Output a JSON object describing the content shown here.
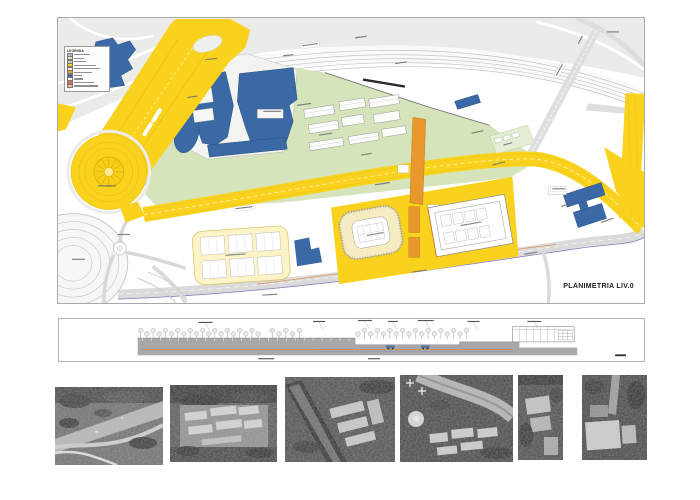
{
  "page": {
    "background": "#ffffff"
  },
  "plan_panel": {
    "title": "PLANIMETRIA LIV.0",
    "legend": {
      "header": "LEGENDA",
      "swatches": [
        {
          "color": "#a9bdd1"
        },
        {
          "color": "#dce9c6"
        },
        {
          "color": "#c3d89b"
        },
        {
          "color": "#f8d21c"
        },
        {
          "color": "#fbf3c8"
        },
        {
          "color": "#eca22e"
        },
        {
          "color": "#3b69a5"
        },
        {
          "color": "#ffffff"
        },
        {
          "color": "#d96a55"
        },
        {
          "color": "#f0bd8d"
        }
      ]
    },
    "palette": {
      "road_yellow": "#f8d21c",
      "overpass_orange": "#eca22e",
      "building_blue": "#3b69a5",
      "lawn_green": "#d5e4ba",
      "sports_green": "#e4eed6",
      "road_gray": "#dedede",
      "tram_purple": "#8d80bd",
      "utility_orange_line": "#df8a3a",
      "paving_pale_yellow": "#fcf4c6"
    }
  },
  "section_panel": {
    "palette": {
      "ground_gray": "#a8a8a8",
      "line_orange": "#d98a3e",
      "line_purple": "#9d93c4"
    }
  },
  "photos": {
    "count": 6,
    "kind": "grayscale aerial photograph"
  }
}
